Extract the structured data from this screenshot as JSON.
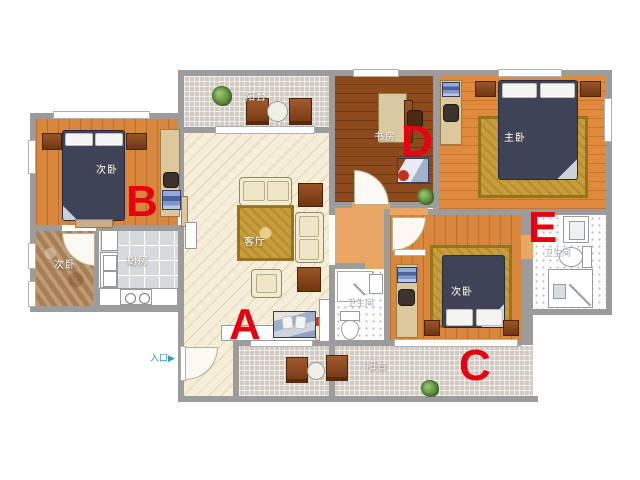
{
  "rooms": {
    "balcony_top": {
      "label": "阳台"
    },
    "living": {
      "label": "客厅"
    },
    "bedroom_b": {
      "label": "次卧"
    },
    "bedroom_small": {
      "label": "次卧"
    },
    "kitchen": {
      "label": "厨房"
    },
    "study": {
      "label": "书房"
    },
    "master": {
      "label": "主卧"
    },
    "bedroom_c": {
      "label": "次卧"
    },
    "bath_left": {
      "label": "卫生间"
    },
    "bath_right": {
      "label": "卫生间"
    },
    "balcony_bottom": {
      "label": "阳台"
    }
  },
  "markers": {
    "a": {
      "label": "A"
    },
    "b": {
      "label": "B"
    },
    "c": {
      "label": "C"
    },
    "d": {
      "label": "D"
    },
    "e": {
      "label": "E"
    }
  },
  "entrance": {
    "label": "入口",
    "arrow": "▶"
  },
  "colors": {
    "marker_red": "#e60012",
    "wall_gray": "#9c9c9c",
    "wood_orange": "#d8873d",
    "wood_dark": "#8d4a1d",
    "living_cream": "#f6eed8",
    "tile_gray": "#d2cbc3",
    "rug_gold": "#c69d3c",
    "bed_navy": "#3e4358",
    "entrance_teal": "#2f9db5"
  }
}
